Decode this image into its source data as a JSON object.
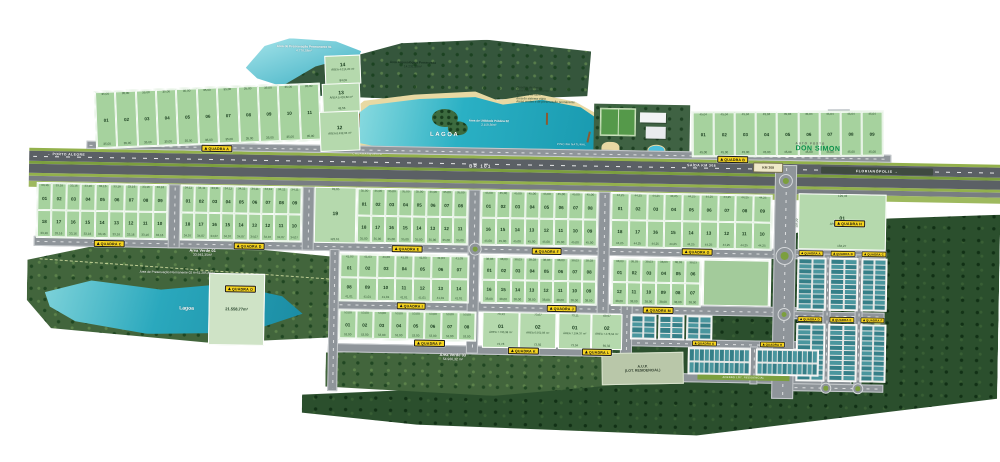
{
  "map": {
    "highway": {
      "left": "← PORTO ALEGRE",
      "name": "BR 101",
      "exit": "SAÍDA KM 308",
      "km_sign": "KM 308",
      "right": "FLORIANÓPOLIS →"
    },
    "landmarks": {
      "app1_title": "Área de Preservação Permanente 01",
      "app1_area": "4.776,58m²",
      "forest_title": "Área Arqueológica Preservada",
      "forest_area": "14.231,16m²",
      "lagoon_label": "LAGOA",
      "aup2_title": "Área de Utilidade Pública 02",
      "aup2_area": "2.158,36m²",
      "bbq": "CHURRASQUEIRA",
      "natural_pool": "PISCINA NATURAL",
      "club_note": "Área de preservação permanente",
      "gas1": "AUTO POSTO",
      "gas2": "DON SIMON",
      "av1_title": "Área Verde 01",
      "av1_area": "33.941,35m²",
      "app2": "Área de Preservação Permanente 02   A=51.205,89m²",
      "lagoa2": "Lagoa",
      "av3_title": "Área Verde 03",
      "av3_area": "54.960,32 m²",
      "aup_res1": "A.U.P.",
      "aup_res2": "(LOT. RESIDENCIAL)",
      "access_road": "ACESSO LOT. RESIDENCIAL"
    },
    "legend": {
      "lines": [
        "Quadro de áreas",
        "Área total do loteamento",
        "Área total de lotes",
        "Área do sistema viário",
        "Áreas verdes e de preservação permanente"
      ]
    },
    "sign_word": "QUADRA",
    "signs": [
      {
        "x": 200,
        "y": 150,
        "l": "A"
      },
      {
        "x": 716,
        "y": 152,
        "l": "B"
      },
      {
        "x": 94,
        "y": 247,
        "l": "C"
      },
      {
        "x": 234,
        "y": 247,
        "l": "D"
      },
      {
        "x": 392,
        "y": 247,
        "l": "E"
      },
      {
        "x": 532,
        "y": 247,
        "l": "F"
      },
      {
        "x": 682,
        "y": 245,
        "l": "G"
      },
      {
        "x": 834,
        "y": 214,
        "l": "H"
      },
      {
        "x": 398,
        "y": 304,
        "l": "I"
      },
      {
        "x": 548,
        "y": 304,
        "l": "J"
      },
      {
        "x": 644,
        "y": 304,
        "l": "M"
      },
      {
        "x": 416,
        "y": 341,
        "l": "P"
      },
      {
        "x": 510,
        "y": 347,
        "l": "K"
      },
      {
        "x": 584,
        "y": 347,
        "l": "L"
      },
      {
        "x": 226,
        "y": 290,
        "l": "O"
      },
      {
        "x": 799,
        "y": 245,
        "l": "A",
        "m": 1
      },
      {
        "x": 831,
        "y": 245,
        "l": "B",
        "m": 1
      },
      {
        "x": 862,
        "y": 245,
        "l": "C",
        "m": 1
      },
      {
        "x": 799,
        "y": 311,
        "l": "D",
        "m": 1
      },
      {
        "x": 831,
        "y": 311,
        "l": "E",
        "m": 1
      },
      {
        "x": 862,
        "y": 311,
        "l": "F",
        "m": 1
      },
      {
        "x": 694,
        "y": 337,
        "l": "G",
        "m": 1
      },
      {
        "x": 762,
        "y": 337,
        "l": "H",
        "m": 1
      }
    ],
    "blocks": [
      {
        "id": "A",
        "x": 93,
        "y": 92,
        "w": 224,
        "h": 56,
        "rot": -3.2,
        "dt": "35,00",
        "db": "35,00",
        "rows": [
          [
            "01",
            "02",
            "03",
            "04",
            "05",
            "06",
            "07",
            "08",
            "09",
            "10",
            "11"
          ]
        ]
      },
      {
        "id": "B",
        "x": 690,
        "y": 106,
        "w": 190,
        "h": 44,
        "rot": -1.2,
        "dt": "45,04",
        "db": "45,00",
        "rows": [
          [
            "01",
            "02",
            "03",
            "04",
            "05",
            "06",
            "07",
            "08",
            "09"
          ]
        ]
      },
      {
        "id": "C",
        "x": 36,
        "y": 190,
        "w": 130,
        "h": 54,
        "dt": "33,16",
        "db": "33,16",
        "rows": [
          [
            "01",
            "02",
            "03",
            "04",
            "05",
            "06",
            "07",
            "08",
            "09"
          ],
          [
            "18",
            "17",
            "16",
            "15",
            "14",
            "13",
            "12",
            "11",
            "10"
          ]
        ]
      },
      {
        "id": "D",
        "x": 180,
        "y": 190,
        "w": 120,
        "h": 54,
        "dt": "34,11",
        "db": "34,07",
        "rows": [
          [
            "01",
            "02",
            "03",
            "04",
            "05",
            "06",
            "07",
            "08",
            "09"
          ],
          [
            "18",
            "17",
            "16",
            "15",
            "14",
            "13",
            "12",
            "11",
            "10"
          ]
        ]
      },
      {
        "id": "E",
        "x": 356,
        "y": 190,
        "w": 110,
        "h": 54,
        "dt": "35,00",
        "db": "35,00",
        "rows": [
          [
            "01",
            "02",
            "03",
            "04",
            "05",
            "06",
            "07",
            "08"
          ],
          [
            "18",
            "17",
            "16",
            "15",
            "14",
            "13",
            "12",
            "11"
          ]
        ]
      },
      {
        "id": "F",
        "x": 480,
        "y": 190,
        "w": 116,
        "h": 54,
        "dt": "45,00",
        "db": "45,00",
        "rows": [
          [
            "01",
            "02",
            "03",
            "04",
            "05",
            "06",
            "07",
            "08"
          ],
          [
            "16",
            "15",
            "14",
            "13",
            "12",
            "11",
            "10",
            "09"
          ]
        ]
      },
      {
        "id": "G",
        "x": 610,
        "y": 190,
        "w": 160,
        "h": 54,
        "dt": "44,25",
        "db": "44,25",
        "rows": [
          [
            "01",
            "02",
            "03",
            "04",
            "05",
            "06",
            "07",
            "08",
            "09"
          ],
          [
            "18",
            "17",
            "16",
            "15",
            "14",
            "13",
            "12",
            "11",
            "10"
          ]
        ]
      },
      {
        "id": "I",
        "x": 340,
        "y": 256,
        "w": 128,
        "h": 46,
        "dt": "41,03",
        "db": "41,01",
        "rows": [
          [
            "01",
            "02",
            "03",
            "04",
            "05",
            "06",
            "07"
          ],
          [
            "08",
            "09",
            "10",
            "11",
            "12",
            "13",
            "14"
          ]
        ]
      },
      {
        "id": "J",
        "x": 482,
        "y": 256,
        "w": 114,
        "h": 46,
        "dt": "38,03",
        "db": "38,00",
        "rows": [
          [
            "01",
            "02",
            "03",
            "04",
            "05",
            "06",
            "07",
            "08"
          ],
          [
            "16",
            "15",
            "14",
            "13",
            "12",
            "11",
            "10",
            "09"
          ]
        ]
      },
      {
        "id": "M",
        "x": 612,
        "y": 256,
        "w": 88,
        "h": 46,
        "dt": "38,03",
        "db": "38,00",
        "rows": [
          [
            "01",
            "02",
            "03",
            "04",
            "05",
            "06"
          ],
          [
            "12",
            "11",
            "10",
            "09",
            "08",
            "07"
          ]
        ]
      },
      {
        "id": "P",
        "x": 340,
        "y": 312,
        "w": 136,
        "h": 28,
        "dt": "53,00",
        "db": "53,00",
        "rows": [
          [
            "01",
            "02",
            "03",
            "04",
            "05",
            "06",
            "07",
            "08"
          ]
        ]
      }
    ],
    "big_lots": [
      {
        "n": "14",
        "x": 322,
        "y": 58,
        "w": 34,
        "h": 27,
        "rot": -3.2,
        "area": "ÁREA 4.014,20 m²",
        "db": "84,09"
      },
      {
        "n": "13",
        "x": 320,
        "y": 86,
        "w": 36,
        "h": 27,
        "rot": -3.2,
        "area": "ÁREA 5.433,82 m²",
        "db": "43,56"
      },
      {
        "n": "12",
        "x": 318,
        "y": 114,
        "w": 38,
        "h": 38,
        "rot": -3.2,
        "area": "ÁREA 8.432,06 m²"
      },
      {
        "n": "19",
        "x": 314,
        "y": 190,
        "w": 40,
        "h": 54,
        "dt": "99,85",
        "db": "123,61"
      },
      {
        "n": "01",
        "x": 798,
        "y": 188,
        "w": 86,
        "h": 54,
        "area": "ÁREA 20.958,04 m²",
        "dt": "129,43",
        "db": "184,27",
        "dl": "107,22",
        "dr": "104,17"
      },
      {
        "n": "01",
        "x": 484,
        "y": 312,
        "w": 35,
        "h": 34,
        "area": "ÁREA 7.790,38 m²",
        "dt": "73,13",
        "db": "73,78"
      },
      {
        "n": "02",
        "x": 521,
        "y": 312,
        "w": 35,
        "h": 34,
        "area": "ÁREA 6.562,06 m²",
        "dt": "73,67",
        "db": "73,92"
      },
      {
        "n": "01",
        "x": 560,
        "y": 312,
        "w": 31,
        "h": 34,
        "area": "ÁREA 7.194,37 m²",
        "dt": "73,11",
        "db": "73,04"
      },
      {
        "n": "02",
        "x": 593,
        "y": 312,
        "w": 29,
        "h": 34,
        "area": "ÁREA 7.278,64 m²",
        "dt": "69,97",
        "db": "69,32"
      },
      {
        "n": "",
        "x": 210,
        "y": 278,
        "w": 54,
        "h": 70,
        "light": true,
        "area": "21.558,77m²"
      }
    ],
    "condos": [
      {
        "x": 798,
        "y": 252,
        "c": 2,
        "r": 10,
        "uw": 11.5,
        "uh": 4,
        "gx": 2,
        "gy": 1
      },
      {
        "x": 830,
        "y": 252,
        "c": 2,
        "r": 10,
        "uw": 11.5,
        "uh": 4,
        "gx": 2,
        "gy": 1
      },
      {
        "x": 862,
        "y": 252,
        "c": 2,
        "r": 10,
        "uw": 10,
        "uh": 4,
        "gx": 2,
        "gy": 1
      },
      {
        "x": 798,
        "y": 318,
        "c": 2,
        "r": 11,
        "uw": 11.5,
        "uh": 4,
        "gx": 2,
        "gy": 1
      },
      {
        "x": 830,
        "y": 318,
        "c": 2,
        "r": 11,
        "uw": 11.5,
        "uh": 4,
        "gx": 2,
        "gy": 1
      },
      {
        "x": 862,
        "y": 318,
        "c": 2,
        "r": 11,
        "uw": 10,
        "uh": 4,
        "gx": 2,
        "gy": 1
      },
      {
        "x": 632,
        "y": 312,
        "c": 2,
        "r": 4,
        "uw": 10,
        "uh": 4.5,
        "gx": 2,
        "gy": 1
      },
      {
        "x": 660,
        "y": 312,
        "c": 2,
        "r": 4,
        "uw": 10,
        "uh": 4.5,
        "gx": 2,
        "gy": 1
      },
      {
        "x": 688,
        "y": 312,
        "c": 2,
        "r": 4,
        "uw": 10,
        "uh": 4.5,
        "gx": 2,
        "gy": 1
      },
      {
        "x": 690,
        "y": 344,
        "c": 12,
        "r": 2,
        "uw": 4,
        "uh": 10.5,
        "gx": 1,
        "gy": 2
      },
      {
        "x": 758,
        "y": 344,
        "c": 12,
        "r": 2,
        "uw": 4,
        "uh": 10.5,
        "gx": 1,
        "gy": 2
      }
    ],
    "condo_colors": [
      "#357f88",
      "#4a969e"
    ]
  }
}
